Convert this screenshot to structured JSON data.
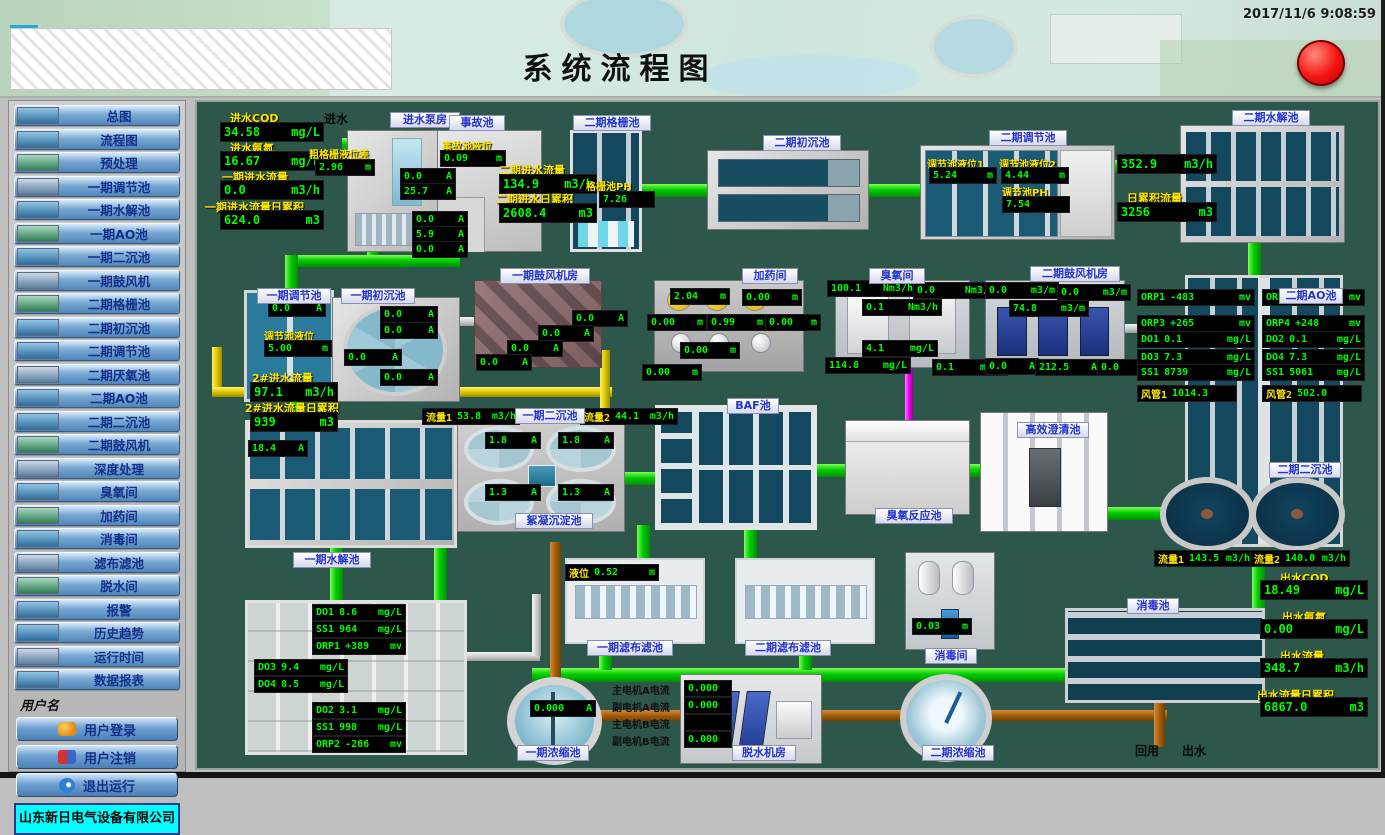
{
  "header": {
    "title": "系统流程图",
    "timestamp": "2017/11/6 9:08:59"
  },
  "sidebar": {
    "menu": [
      "总图",
      "流程图",
      "预处理",
      "一期调节池",
      "一期水解池",
      "一期AO池",
      "一期二沉池",
      "一期鼓风机",
      "二期格栅池",
      "二期初沉池",
      "二期调节池",
      "二期厌氧池",
      "二期AO池",
      "二期二沉池",
      "二期鼓风机",
      "深度处理",
      "臭氧间",
      "加药间",
      "消毒间",
      "滤布滤池",
      "脱水间",
      "报警",
      "历史趋势",
      "运行时间",
      "数据报表"
    ],
    "username_label": "用户名",
    "login": "用户登录",
    "logout": "用户注销",
    "exit": "退出运行",
    "company": "山东新日电气设备有限公司"
  },
  "colors": {
    "value_green": "#00ff00",
    "label_yellow": "#ffe600",
    "plate_blue": "#2433cc",
    "pipe_green": "#00cc00",
    "pipe_yellow": "#e2cc00",
    "pipe_orange": "#a65e08",
    "pipe_magenta": "#ee00ee",
    "alarm_red": "#f51414",
    "company_cyan": "#00ffff",
    "diagram_bg": "#2e574b"
  },
  "diagram": {
    "texts": {
      "inflow": "进水",
      "reuse": "回用",
      "outflow": "出水"
    },
    "plates": {
      "pump_house": "进水泵房",
      "accident_pool": "事故池",
      "p2_grid": "二期格栅池",
      "p2_primary": "二期初沉池",
      "p2_regulating": "二期调节池",
      "p2_hydrolysis": "二期水解池",
      "p1_regulating": "一期调节池",
      "p1_primary": "一期初沉池",
      "p1_blower": "一期鼓风机房",
      "dosing_room": "加药间",
      "ozone_room": "臭氧间",
      "p2_blower": "二期鼓风机房",
      "p2_ao": "二期AO池",
      "p1_hydrolysis": "一期水解池",
      "p1_secondary": "一期二沉池",
      "floc_pool": "絮凝沉淀池",
      "baf": "BAF池",
      "ozone_reactor": "臭氧反应池",
      "clarifier": "高效澄清池",
      "p2_secondary": "二期二沉池",
      "p1_filter": "一期滤布滤池",
      "p2_filter": "二期滤布滤池",
      "disinfect_room": "消毒间",
      "disinfect_pool": "消毒池",
      "p1_thickener": "一期浓缩池",
      "dewatering": "脱水机房",
      "p2_thickener": "二期浓缩池"
    },
    "inlet_stats": [
      {
        "label": "进水COD",
        "value": "34.58",
        "unit": "mg/L"
      },
      {
        "label": "进水氨氮",
        "value": "16.67",
        "unit": "mg/L"
      },
      {
        "label": "一期进水流量",
        "value": "0.0",
        "unit": "m3/h"
      },
      {
        "label": "一期进水流量日累积",
        "value": "624.0",
        "unit": "m3"
      }
    ],
    "outlet_stats": [
      {
        "label": "出水COD",
        "value": "18.49",
        "unit": "mg/L"
      },
      {
        "label": "出水氨氮",
        "value": "0.00",
        "unit": "mg/L"
      },
      {
        "label": "出水流量",
        "value": "348.7",
        "unit": "m3/h"
      },
      {
        "label": "出水流量日累积",
        "value": "6867.0",
        "unit": "m3"
      }
    ],
    "values": {
      "coarse_grid_level": {
        "label": "粗格栅液位差",
        "v": "2.96",
        "u": "m"
      },
      "accident_level": {
        "label": "事故池液位",
        "v": "0.09",
        "u": "m"
      },
      "p2_in_flow": {
        "label": "二期进水流量",
        "v": "134.9",
        "u": "m3/h"
      },
      "p2_in_total": {
        "label": "二期进水日累积",
        "v": "2608.4",
        "u": "m3"
      },
      "grid_ph": {
        "label": "格栅池PH",
        "v": "7.26"
      },
      "reg2_level1": {
        "label": "调节池液位1",
        "v": "5.24",
        "u": "m"
      },
      "reg2_level2": {
        "label": "调节池液位2",
        "v": "4.44",
        "u": "m"
      },
      "reg2_ph": {
        "label": "调节池PH",
        "v": "7.54"
      },
      "hyd2_flow": {
        "v": "352.9",
        "u": "m3/h"
      },
      "hyd2_total": {
        "label": "日累积流量",
        "v": "3256",
        "u": "m3"
      },
      "pump_a1": {
        "v": "0.0",
        "u": "A"
      },
      "pump_a2": {
        "v": "25.7",
        "u": "A"
      },
      "pump_a3": {
        "v": "0.0",
        "u": "A"
      },
      "pump_a4": {
        "v": "5.9",
        "u": "A"
      },
      "pump_a5": {
        "v": "0.0",
        "u": "A"
      },
      "reg1_a": {
        "v": "0.0",
        "u": "A"
      },
      "reg1_level": {
        "label": "调节池液位",
        "v": "5.00",
        "u": "m"
      },
      "p1_flow2": {
        "label": "2#进水流量",
        "v": "97.1",
        "u": "m3/h"
      },
      "p1_flow2_total": {
        "label": "2#进水流量日累积",
        "v": "939",
        "u": "m3"
      },
      "pri1_a1": {
        "v": "0.0",
        "u": "A"
      },
      "pri1_a2": {
        "v": "0.0",
        "u": "A"
      },
      "pri1_a3": {
        "v": "0.0",
        "u": "A"
      },
      "pri1_a4": {
        "v": "0.0",
        "u": "A"
      },
      "b1_a1": {
        "v": "0.0",
        "u": "A"
      },
      "b1_a2": {
        "v": "0.0",
        "u": "A"
      },
      "b1_a3": {
        "v": "0.0",
        "u": "A"
      },
      "b1_a4": {
        "v": "0.0",
        "u": "A"
      },
      "dos_1": {
        "v": "2.04",
        "u": "m"
      },
      "dos_2": {
        "v": "0.00",
        "u": "m"
      },
      "dos_3": {
        "v": "0.00",
        "u": "m"
      },
      "dos_4": {
        "v": "0.99",
        "u": "m"
      },
      "dos_5": {
        "v": "0.00",
        "u": "m"
      },
      "dos_6": {
        "v": "0.00",
        "u": "m"
      },
      "dos_7": {
        "v": "0.00",
        "u": "m"
      },
      "oz_1": {
        "v": "100.1",
        "u": "Nm3/h"
      },
      "oz_2": {
        "v": "0.0",
        "u": "Nm3/h"
      },
      "oz_3": {
        "v": "0.1",
        "u": "Nm3/h"
      },
      "oz_4": {
        "v": "4.1",
        "u": "mg/L"
      },
      "oz_5": {
        "v": "114.8",
        "u": "mg/L"
      },
      "oz_6": {
        "v": "0.1",
        "u": "mg/L"
      },
      "b2_1": {
        "v": "0.0",
        "u": "m3/m"
      },
      "b2_2": {
        "v": "0.0",
        "u": "m3/m"
      },
      "b2_3": {
        "v": "74.8",
        "u": "m3/m"
      },
      "b2_4": {
        "v": "0.0",
        "u": "A"
      },
      "b2_5": {
        "v": "212.5",
        "u": "A"
      },
      "b2_6": {
        "v": "0.0",
        "u": "A"
      },
      "ao2_orp1": {
        "n": "ORP1",
        "v": "-483",
        "u": "mv"
      },
      "ao2_orp2": {
        "n": "ORP2",
        "v": "-523",
        "u": "mv"
      },
      "ao2_orp3": {
        "n": "ORP3",
        "v": "+265",
        "u": "mv"
      },
      "ao2_orp4": {
        "n": "ORP4",
        "v": "+248",
        "u": "mv"
      },
      "ao2_do1": {
        "n": "DO1",
        "v": "0.1",
        "u": "mg/L"
      },
      "ao2_do2": {
        "n": "DO2",
        "v": "0.1",
        "u": "mg/L"
      },
      "ao2_do3": {
        "n": "DO3",
        "v": "7.3",
        "u": "mg/L"
      },
      "ao2_do4": {
        "n": "DO4",
        "v": "7.3",
        "u": "mg/L"
      },
      "ao2_ss1": {
        "n": "SS1",
        "v": "8739",
        "u": "mg/L"
      },
      "ao2_ss2": {
        "n": "SS1",
        "v": "5061",
        "u": "mg/L"
      },
      "ao2_duct1": {
        "n": "风管1",
        "v": "1014.3"
      },
      "ao2_duct2": {
        "n": "风管2",
        "v": "502.0"
      },
      "sec1_flow1": {
        "n": "流量1",
        "v": "53.8",
        "u": "m3/h"
      },
      "sec1_flow2": {
        "n": "流量2",
        "v": "44.1",
        "u": "m3/h"
      },
      "sec1_a1": {
        "v": "1.8",
        "u": "A"
      },
      "sec1_a2": {
        "v": "1.8",
        "u": "A"
      },
      "sec1_a3": {
        "v": "1.3",
        "u": "A"
      },
      "sec1_a4": {
        "v": "1.3",
        "u": "A"
      },
      "hyd1_a": {
        "v": "18.4",
        "u": "A"
      },
      "ao1_do1": {
        "n": "DO1",
        "v": "8.6",
        "u": "mg/L"
      },
      "ao1_ss1": {
        "n": "SS1",
        "v": "964",
        "u": "mg/L"
      },
      "ao1_orp1": {
        "n": "ORP1",
        "v": "+389",
        "u": "mv"
      },
      "ao1_do3": {
        "n": "DO3",
        "v": "9.4",
        "u": "mg/L"
      },
      "ao1_do4": {
        "n": "DO4",
        "v": "8.5",
        "u": "mg/L"
      },
      "ao1_do2": {
        "n": "DO2",
        "v": "3.1",
        "u": "mg/L"
      },
      "ao1_ss2": {
        "n": "SS1",
        "v": "998",
        "u": "mg/L"
      },
      "ao1_orp2": {
        "n": "ORP2",
        "v": "-266",
        "u": "mv"
      },
      "filter1_level": {
        "n": "液位",
        "v": "0.52",
        "u": "m"
      },
      "disinfect_level": {
        "v": "0.03",
        "u": "m"
      },
      "sec2_flow1": {
        "n": "流量1",
        "v": "143.5",
        "u": "m3/h"
      },
      "sec2_flow2": {
        "n": "流量2",
        "v": "140.0",
        "u": "m3/h"
      },
      "thick1_a": {
        "v": "0.000",
        "u": "A"
      },
      "dw_1": {
        "label": "主电机A电流",
        "v": "0.000"
      },
      "dw_2": {
        "label": "副电机A电流",
        "v": "0.000"
      },
      "dw_3": {
        "label": "主电机B电流",
        "v": "0.000"
      },
      "dw_4": {
        "label": "副电机B电流",
        "v": "0.000"
      }
    }
  }
}
